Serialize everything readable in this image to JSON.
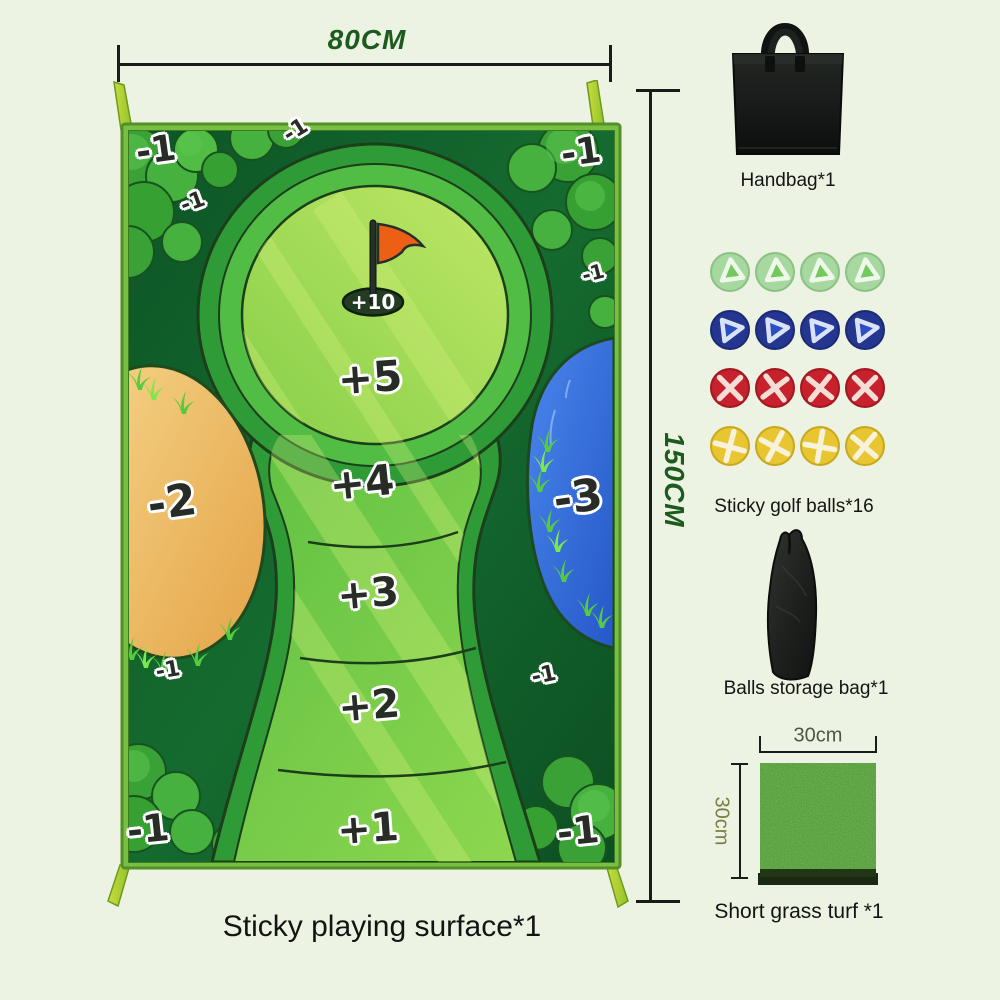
{
  "page": {
    "background_color": "#ecf3e2"
  },
  "mat": {
    "caption": "Sticky playing surface*1",
    "width_label": "80CM",
    "height_label": "150CM",
    "hole_label": "+10",
    "zone5": "+5",
    "zone4": "+4",
    "zone3": "+3",
    "zone2": "+2",
    "zone1": "+1",
    "bunker_label": "-2",
    "water_label": "-3",
    "penalty_label": "-1",
    "colors": {
      "fairway_green": "#7ccf4a",
      "rough_green": "#0d5526",
      "bunker_sand": "#edb95f",
      "water_blue": "#2f6bdc",
      "frame_green": "#79bf42",
      "flag_orange": "#ee5f16"
    }
  },
  "kit": {
    "handbag": {
      "caption": "Handbag*1"
    },
    "balls": {
      "caption": "Sticky golf balls*16",
      "count": 16,
      "colors": {
        "green": "#74c85c",
        "blue": "#2b4fc2",
        "red": "#c6212c",
        "yellow": "#e7c631"
      }
    },
    "storage_bag": {
      "caption": "Balls storage bag*1"
    },
    "turf": {
      "caption": "Short grass turf *1",
      "width_label": "30cm",
      "height_label": "30cm"
    }
  }
}
